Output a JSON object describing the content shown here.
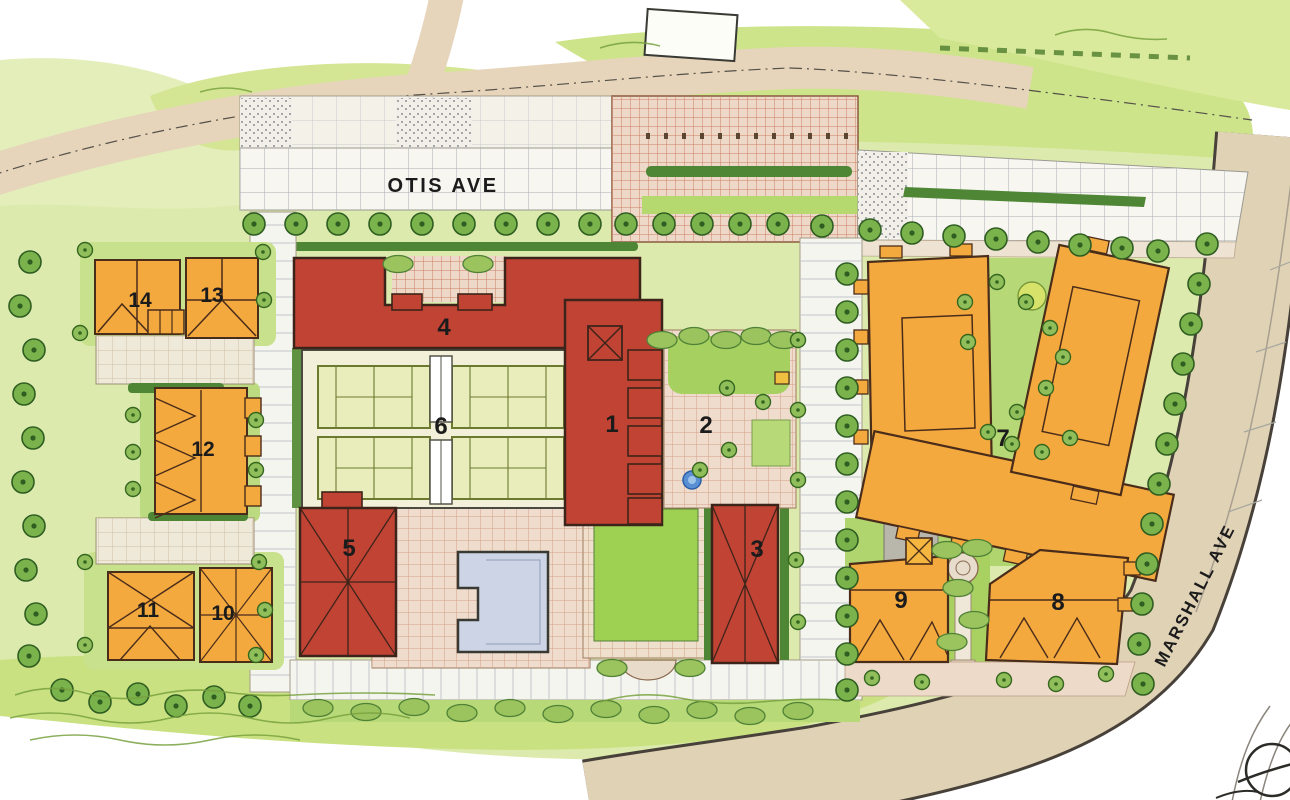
{
  "plan": {
    "title": "Illustrative site plan",
    "streets": [
      {
        "name": "OTIS AVE"
      },
      {
        "name": "MARSHALL AVE"
      }
    ],
    "buildings": [
      {
        "number": "1",
        "color": "red"
      },
      {
        "number": "2",
        "color": "courtyard"
      },
      {
        "number": "3",
        "color": "red"
      },
      {
        "number": "4",
        "color": "red"
      },
      {
        "number": "5",
        "color": "red"
      },
      {
        "number": "6",
        "color": "tennis-deck"
      },
      {
        "number": "7",
        "color": "orange"
      },
      {
        "number": "8",
        "color": "orange"
      },
      {
        "number": "9",
        "color": "orange"
      },
      {
        "number": "10",
        "color": "orange"
      },
      {
        "number": "11",
        "color": "orange"
      },
      {
        "number": "12",
        "color": "orange"
      },
      {
        "number": "13",
        "color": "orange"
      },
      {
        "number": "14",
        "color": "orange"
      }
    ],
    "features": {
      "tennis_court_count": 4,
      "swimming_pool": true,
      "north_arrow": true
    },
    "palette": {
      "red_building": "#c14334",
      "orange_building": "#f3a93e",
      "street_tan": "#e0d2b5",
      "plaza_paving": "#eed8c8",
      "lawn": "#a8d162",
      "wash_green": "#dcebad",
      "pool_water": "#ccd4e6",
      "tree_green": "#7ab24b",
      "hedge_green": "#4e8636",
      "outline": "#4a2c1a"
    }
  }
}
